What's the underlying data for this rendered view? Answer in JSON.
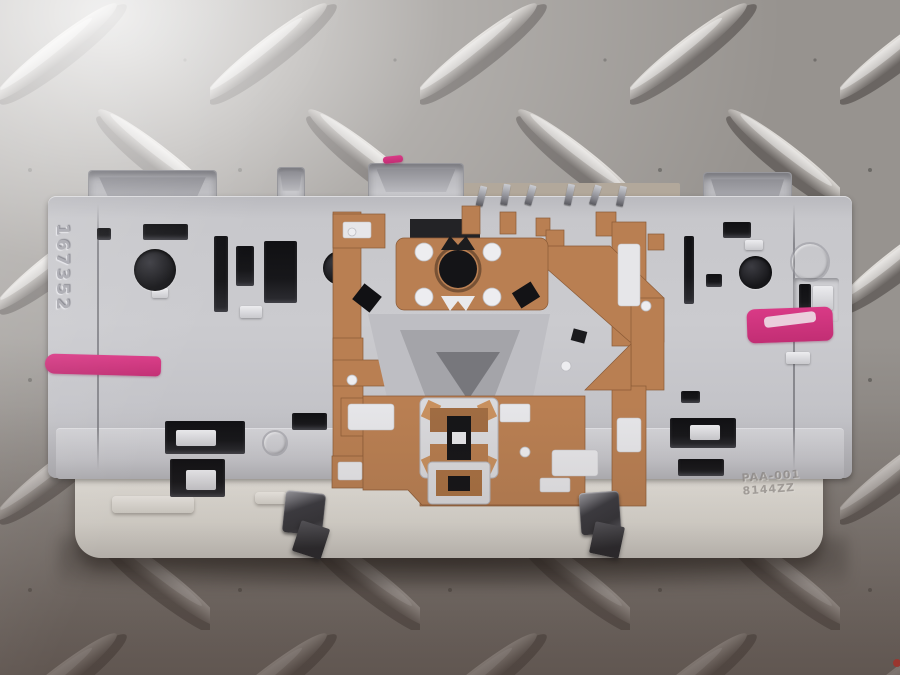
{
  "scene": {
    "subject": "rear view of a car interior dome-light module with stamped copper busbar circuit",
    "surface": "aluminium diamond tread plate"
  },
  "part": {
    "serial_number": "167352",
    "mold_marking_line1": "PAA-001",
    "mold_marking_line2": "8144ZZ"
  },
  "colors": {
    "bgBase": "#97938f",
    "bgRidgeLight": "#dedbd7",
    "bgShadow": "#524d49",
    "housing": "#c7c7cb",
    "housingShadow": "#97979c",
    "lens": "#eae7e1",
    "copper": "#b97f52",
    "copperDark": "#8a5a36",
    "blk": "#17171a",
    "pink": "#d93a86",
    "steelDark": "#333338",
    "reflGray": "#a9a9ae"
  }
}
